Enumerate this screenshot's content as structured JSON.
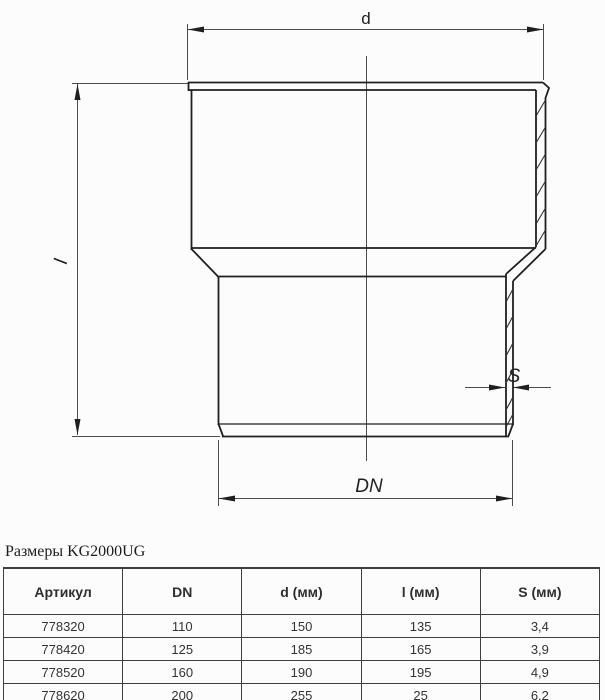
{
  "drawing": {
    "dim_d_label": "d",
    "dim_l_label": "l",
    "dim_s_label": "S",
    "dim_dn_label": "DN"
  },
  "table": {
    "caption": "Размеры KG2000UG",
    "headers": [
      "Артикул",
      "DN",
      "d (мм)",
      "l (мм)",
      "S (мм)"
    ],
    "rows": [
      [
        "778320",
        "110",
        "150",
        "135",
        "3,4"
      ],
      [
        "778420",
        "125",
        "185",
        "165",
        "3,9"
      ],
      [
        "778520",
        "160",
        "190",
        "195",
        "4,9"
      ],
      [
        "778620",
        "200",
        "255",
        "25",
        "6,2"
      ]
    ]
  },
  "colors": {
    "object_line": "#1f1f1f",
    "thin_line": "#4d4d4d",
    "table_border": "#3f3f3f",
    "background": "#fcfcfc"
  }
}
